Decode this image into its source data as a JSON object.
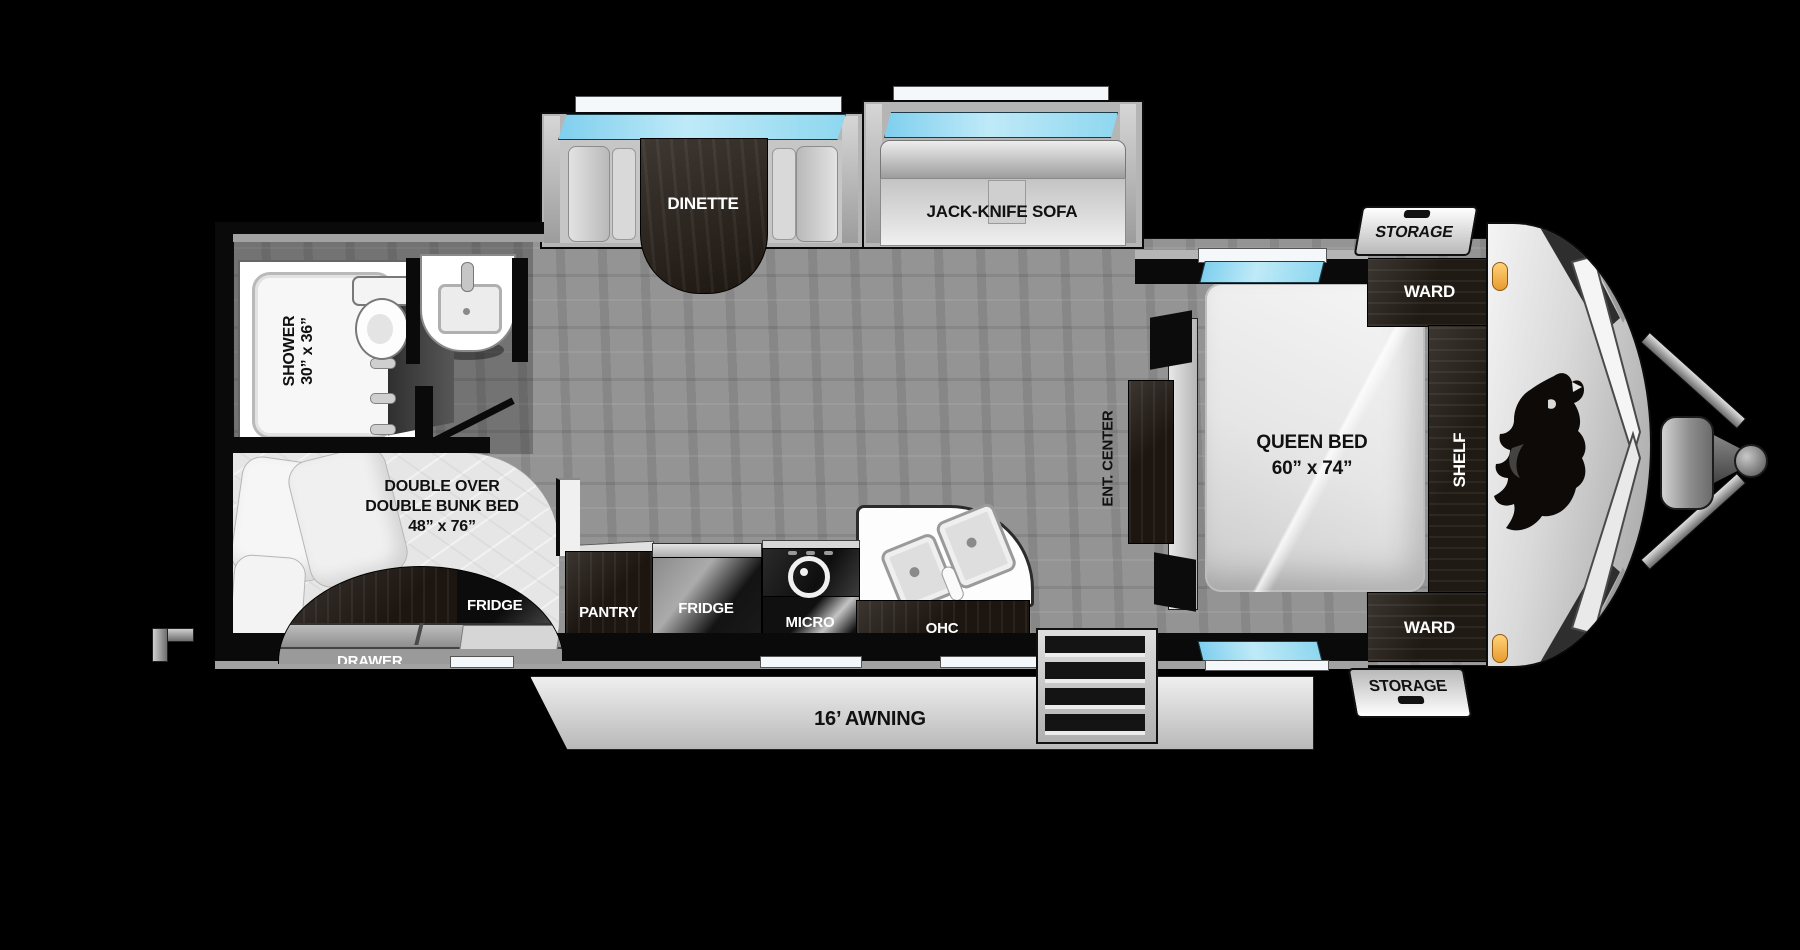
{
  "title": "Travel trailer floorplan",
  "labels": {
    "dinette": "DINETTE",
    "sofa": "JACK-KNIFE SOFA",
    "storage": "STORAGE",
    "ward": "WARD",
    "shelf": "SHELF",
    "queen_bed": "QUEEN BED",
    "queen_bed_size": "60” x 74”",
    "ent_center": "ENT. CENTER",
    "shower": "SHOWER",
    "shower_size": "30” x 36”",
    "bunk_line1": "DOUBLE OVER",
    "bunk_line2": "DOUBLE BUNK BED",
    "bunk_size": "48” x 76”",
    "bunk_fridge": "FRIDGE",
    "drawer": "DRAWER",
    "pantry": "PANTRY",
    "fridge": "FRIDGE",
    "micro": "MICRO",
    "ohc": "OHC",
    "awning": "16’ AWNING"
  },
  "colors": {
    "background": "#000000",
    "floor": "#8e8e8e",
    "walls": "#0a0a0a",
    "slide_gray": "#b5b5b5",
    "dark_wood": "#1c1510",
    "window_glass": "#8ed7ef",
    "fixture_white": "#f7f7f7",
    "marker_amber": "#f0a832"
  }
}
